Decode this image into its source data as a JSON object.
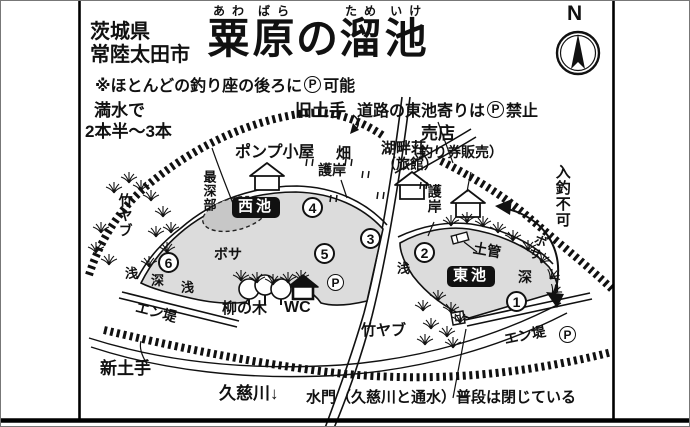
{
  "header": {
    "prefecture": "茨城県",
    "city": "常陸太田市",
    "title_ruby": [
      {
        "ruby": "あわ",
        "base": "粟"
      },
      {
        "ruby": "ばら",
        "base": "原"
      },
      {
        "ruby": "",
        "base": "の"
      },
      {
        "ruby": "ため",
        "base": "溜"
      },
      {
        "ruby": "いけ",
        "base": "池"
      }
    ],
    "note": {
      "pre": "※ほとんどの釣り座の後ろに",
      "p": "P",
      "post": "可能"
    }
  },
  "compass": {
    "label": "N"
  },
  "labels": {
    "full_water_line1": "満水で",
    "full_water_line2": "2本半～3本",
    "old_embankment": "旧土手",
    "road_parking": {
      "pre": "道路の東池寄りは",
      "p": "P",
      "post": "禁止"
    },
    "pump_hut": "ポンプ小屋",
    "field": "畑",
    "revetment_top": "護岸",
    "inn": "湖畔荘",
    "inn_sub": "（旅館）",
    "shop": "売店",
    "shop_sub": "（釣り券販売）",
    "revetment_road": "護岸",
    "deepest_point": "最深部",
    "west_pond": "西池",
    "east_pond": "東池",
    "bamboo_left": "竹ヤブ",
    "bamboo_bottom": "竹ヤブ",
    "bosa_west": "ボサ",
    "bosa_east": "ボサ",
    "willow": "柳の木",
    "toilet": "WC",
    "shallow1": "浅",
    "deep_west": "深",
    "shallow2": "浅",
    "shallow_east": "浅",
    "deep_east": "深",
    "clay_pipe": "土管",
    "no_entry": "入釣不可",
    "embankment_west": "エン堤",
    "embankment_east": "エン堤",
    "parking": "P",
    "new_embankment": "新土手",
    "river": "久慈川",
    "river_arrow": "↓",
    "sluice_note": "水門（久慈川と通水）普段は閉じている"
  },
  "spots": [
    "1",
    "2",
    "3",
    "4",
    "5",
    "6"
  ]
}
